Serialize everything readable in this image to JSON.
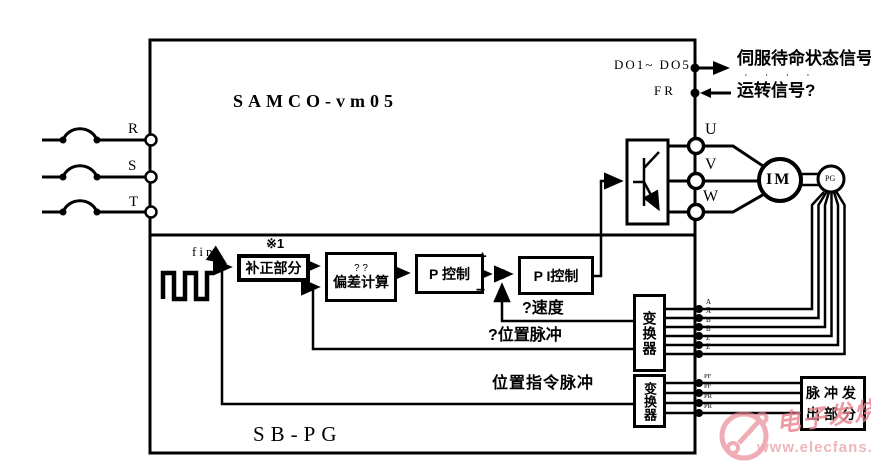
{
  "colors": {
    "line": "#000000",
    "watermark": "#e8838f"
  },
  "diagram": {
    "main_unit_label": "SAMCO-vm05",
    "sub_unit_label": "SB-PG",
    "phase_inputs": [
      "R",
      "S",
      "T"
    ],
    "digital_outputs": {
      "label": "DO1~ DO5",
      "signal": "伺服待命状态信号",
      "dots": "· · · ·"
    },
    "run_input": {
      "label": "FR",
      "signal": "运转信号?"
    },
    "motor_outputs": [
      "U",
      "V",
      "W"
    ],
    "motor_label": "IM",
    "encoder_label": "PG",
    "blocks": {
      "correction": "补正部分",
      "correction_note": "※1",
      "deviation_top": "? ?",
      "deviation": "偏差计算",
      "p_control": "P 控制",
      "pi_control": "P I控制",
      "converter_top": "变换器",
      "converter_bottom": "变换器",
      "pulse_generator": "脉冲发出部分"
    },
    "signals": {
      "fin": "fin",
      "speed": "?速度",
      "position_pulse": "?位置脉冲",
      "position_cmd_pulse": "位置指令脉冲",
      "plus": "+",
      "minus": "−"
    },
    "encoder_channels": [
      "A",
      "A̅",
      "B",
      "B̅",
      "Z",
      "Z̅"
    ],
    "pulse_channels": [
      "PF",
      "P̅F̅",
      "PR",
      "P̅R̅"
    ]
  },
  "watermark": {
    "name": "电子发烧友",
    "url": "www.elecfans.com"
  }
}
